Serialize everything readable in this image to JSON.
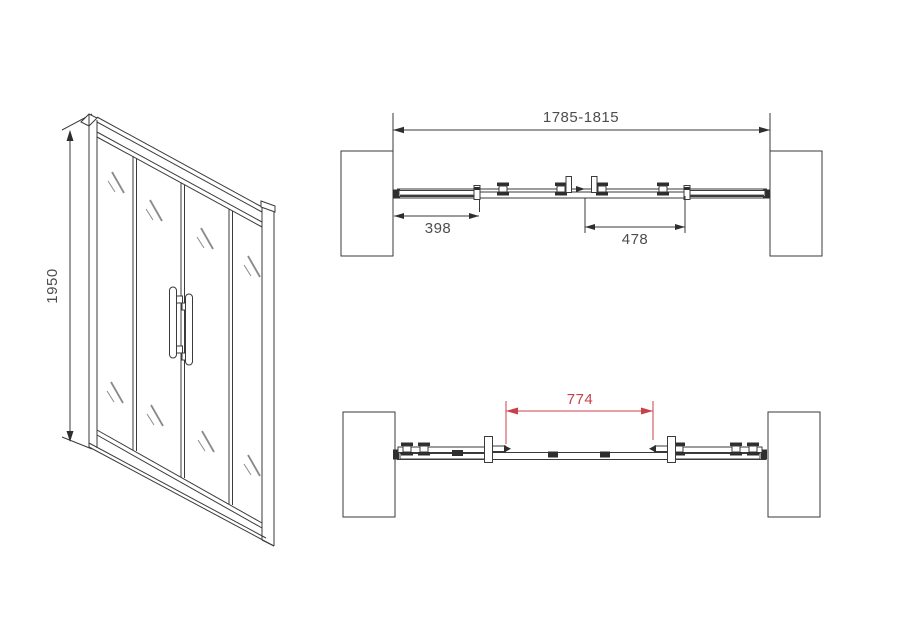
{
  "drawing": {
    "subject": "sliding-shower-door-technical-drawing",
    "colors": {
      "line": "#3a3a3a",
      "dimension_text": "#4d4d4d",
      "accent_red": "#c84048",
      "background": "#ffffff"
    },
    "front_view": {
      "height_dimension": "1950"
    },
    "plan_view_closed": {
      "overall_width_dimension": "1785-1815",
      "left_fixed_panel_dimension": "398",
      "sliding_panel_dimension": "478"
    },
    "plan_view_open": {
      "opening_dimension": "774"
    }
  }
}
